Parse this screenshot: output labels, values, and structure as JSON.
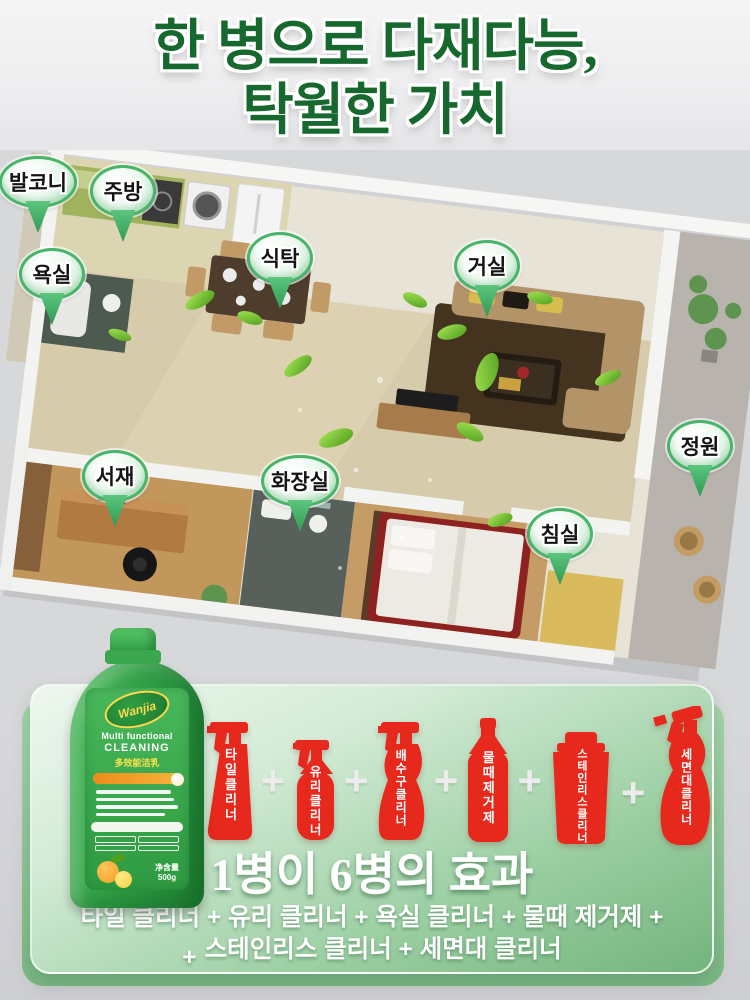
{
  "title": {
    "line1": "한 병으로 다재다능,",
    "line2": "탁월한 가치"
  },
  "rooms": [
    {
      "id": "balcony",
      "label": "발코니"
    },
    {
      "id": "kitchen",
      "label": "주방"
    },
    {
      "id": "bathroom",
      "label": "욕실"
    },
    {
      "id": "dining-table",
      "label": "식탁"
    },
    {
      "id": "living-room",
      "label": "거실"
    },
    {
      "id": "garden",
      "label": "정원"
    },
    {
      "id": "study",
      "label": "서재"
    },
    {
      "id": "toilet",
      "label": "화장실"
    },
    {
      "id": "bedroom",
      "label": "침실"
    }
  ],
  "panel": {
    "equals_sign": "=",
    "plus_sign": "+",
    "product_bottle": {
      "brand": "Wanjia",
      "name_en_line1": "Multi functional",
      "name_en_line2": "CLEANING",
      "name_cn": "多效能洁乳",
      "net_weight_label": "净含量",
      "net_weight_value": "500g"
    },
    "spray_bottles": [
      {
        "label": "타일클리너"
      },
      {
        "label": "유리클리너"
      },
      {
        "label": "배수구클리너"
      },
      {
        "label": "물때제거제"
      },
      {
        "label": "스테인리스클리너"
      },
      {
        "label": "세면대클리너"
      }
    ],
    "headline": "1병이 6병의 효과",
    "formula_line1": "타일 클리너 + 유리 클리너 + 욕실 클리너 + 물때 제거제 +",
    "formula_line2_prefix": "+",
    "formula_line2": "스테인리스 클리너 + 세면대 클리너"
  },
  "colors": {
    "title_green": "#17682e",
    "pin_green": "#49b56a",
    "panel_green_light": "#d5ecd8",
    "panel_green": "#74b47d",
    "bottle_red": "#e7281c",
    "product_green": "#2f9e44"
  }
}
